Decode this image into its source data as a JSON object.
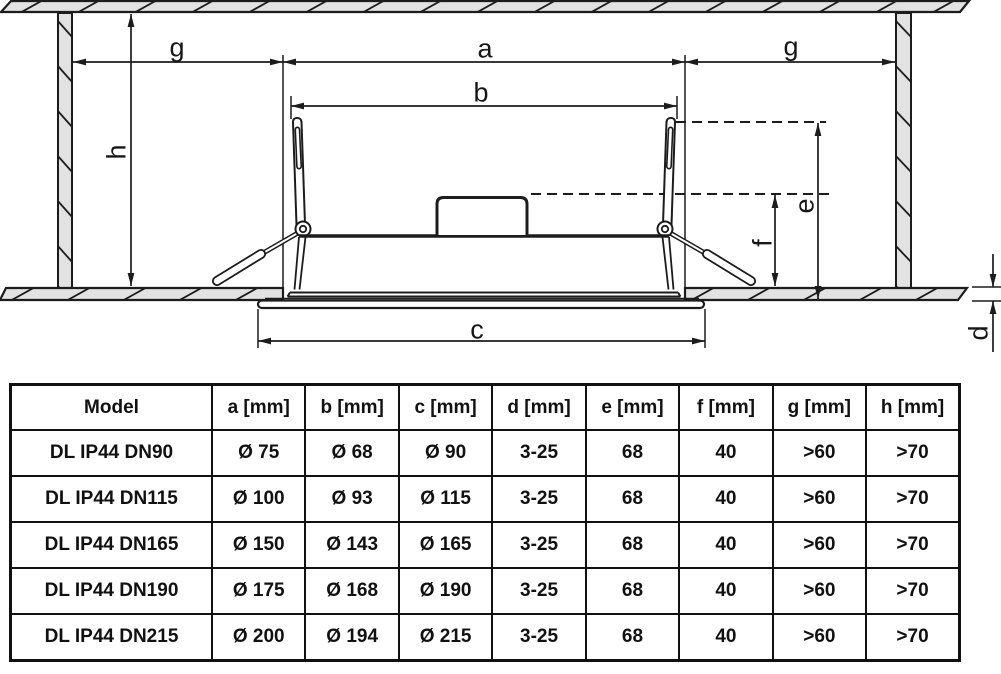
{
  "diagram": {
    "labels": {
      "a": "a",
      "b": "b",
      "c": "c",
      "d": "d",
      "e": "e",
      "f": "f",
      "g_left": "g",
      "g_right": "g",
      "h": "h"
    }
  },
  "table": {
    "columns": [
      "Model",
      "a [mm]",
      "b [mm]",
      "c [mm]",
      "d [mm]",
      "e [mm]",
      "f [mm]",
      "g [mm]",
      "h [mm]"
    ],
    "rows": [
      [
        "DL IP44 DN90",
        "Ø 75",
        "Ø 68",
        "Ø 90",
        "3-25",
        "68",
        "40",
        ">60",
        ">70"
      ],
      [
        "DL IP44 DN115",
        "Ø 100",
        "Ø 93",
        "Ø 115",
        "3-25",
        "68",
        "40",
        ">60",
        ">70"
      ],
      [
        "DL IP44 DN165",
        "Ø 150",
        "Ø 143",
        "Ø 165",
        "3-25",
        "68",
        "40",
        ">60",
        ">70"
      ],
      [
        "DL IP44 DN190",
        "Ø 175",
        "Ø 168",
        "Ø 190",
        "3-25",
        "68",
        "40",
        ">60",
        ">70"
      ],
      [
        "DL IP44 DN215",
        "Ø 200",
        "Ø 194",
        "Ø 215",
        "3-25",
        "68",
        "40",
        ">60",
        ">70"
      ]
    ]
  },
  "colors": {
    "line": "#1c1c1c",
    "ceiling_fill": "#e2e2e2",
    "background": "#ffffff"
  }
}
